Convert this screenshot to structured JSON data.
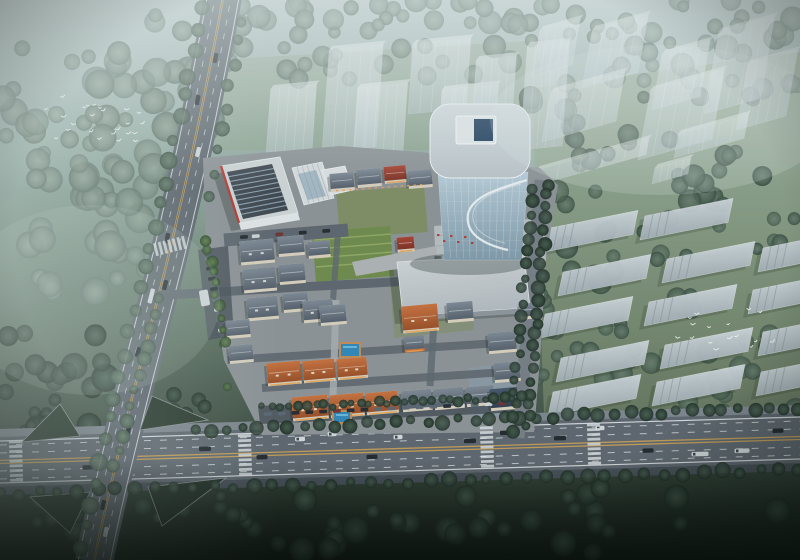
{
  "meta": {
    "subject": "Dusk aerial rendering of a mixed-use development: central glass office tower, low-rise European village with orange and slate roofs, striped-roof commercial block, tree-lined boulevards with traffic, ghosted context towers and slab housing rows, flocks of white birds"
  },
  "palette": {
    "sky_top": "#b9c8c7",
    "sky_mid": "#8ea69c",
    "sky_low": "#5e7263",
    "ground_dark": "#141e17",
    "mist": "#e2ebeb",
    "forest_dark": "#2c3e33",
    "forest_mid": "#4d6253",
    "forest_hazy": "#76897e",
    "tree_site": "#3f5d36",
    "tree_yellow": "#b5913c",
    "lawn_right": "#8a9a77",
    "lawn_site": "#7d8d5e",
    "lawn_bright": "#6f8a4a",
    "road": "#5d656d",
    "road_dark": "#464e56",
    "sidewalk": "#7c848c",
    "lane_yellow": "#c29a55",
    "lane_white": "#e8ecef",
    "pavement": "#8d9296",
    "plaza": "#b7bcbe",
    "facade": "#d8cfbd",
    "roof_orange": "#c8703c",
    "roof_orange_dark": "#9a4e26",
    "roof_slate": "#7d8894",
    "roof_slate_dark": "#545e6a",
    "roof_red": "#a84232",
    "roof_red_dark": "#7c2e22",
    "roof_blue": "#46566b",
    "roof_blue_dark": "#2e3b4d",
    "ghost": "#d9e2e8",
    "slab": "#cdd6dc",
    "slab_dark": "#a9b4bc",
    "glass_light": "#b7ccd8",
    "glass_dark": "#7f98a8",
    "tower_roof": "#d3dade",
    "tower_roof_dark": "#b9c2c8",
    "skylight_blue": "#1f3c5c",
    "hall_light": "#d2d6d8",
    "hall_dark": "#b3bac0",
    "stripe_roof": "#3e454e",
    "stripe_light": "#9fb6c6",
    "accent_red": "#b23b35",
    "pool_blue": "#2f86b8",
    "pool_deck": "#c08b55",
    "car_dark": "#20262c",
    "car_mid": "#5a6673",
    "car_white": "#d3d8db",
    "car_red": "#6e3030",
    "glow_warm": "#e8a04c",
    "bird": "#f2f5f4"
  },
  "scene": {
    "ghost_towers_center": [
      [
        266,
        155,
        46,
        66
      ],
      [
        322,
        152,
        54,
        102
      ],
      [
        352,
        170,
        50,
        82
      ],
      [
        408,
        114,
        58,
        70
      ],
      [
        437,
        162,
        56,
        72
      ],
      [
        472,
        122,
        40,
        62
      ],
      [
        520,
        150,
        42,
        104
      ]
    ],
    "ghost_towers_right": [
      [
        532,
        76,
        40,
        46
      ],
      [
        582,
        88,
        56,
        58
      ],
      [
        652,
        110,
        48,
        56
      ],
      [
        704,
        114,
        56,
        82
      ],
      [
        736,
        130,
        50,
        66
      ],
      [
        542,
        142,
        74,
        50
      ],
      [
        638,
        160,
        74,
        70
      ],
      [
        674,
        158,
        70,
        24
      ],
      [
        534,
        186,
        112,
        16
      ],
      [
        652,
        184,
        36,
        16
      ]
    ],
    "ghost_slabs": [
      [
        545,
        252
      ],
      [
        640,
        240
      ],
      [
        558,
        296
      ],
      [
        662,
        283
      ],
      [
        758,
        272
      ],
      [
        540,
        338
      ],
      [
        644,
        326
      ],
      [
        748,
        314
      ],
      [
        556,
        382
      ],
      [
        660,
        369
      ],
      [
        758,
        356
      ],
      [
        548,
        416
      ],
      [
        652,
        406
      ],
      [
        756,
        396
      ]
    ],
    "village": [
      [
        330,
        173,
        24,
        15,
        "slate"
      ],
      [
        357,
        169,
        24,
        15,
        "slate"
      ],
      [
        384,
        166,
        22,
        14,
        "red"
      ],
      [
        408,
        170,
        24,
        15,
        "slate"
      ],
      [
        240,
        240,
        34,
        21,
        "slate"
      ],
      [
        278,
        236,
        26,
        17,
        "slate"
      ],
      [
        308,
        241,
        22,
        14,
        "slate"
      ],
      [
        243,
        268,
        33,
        21,
        "slate"
      ],
      [
        279,
        264,
        26,
        17,
        "slate"
      ],
      [
        247,
        297,
        31,
        20,
        "slate"
      ],
      [
        283,
        293,
        25,
        16,
        "slate"
      ],
      [
        303,
        300,
        30,
        19,
        "slate"
      ],
      [
        226,
        320,
        24,
        15,
        "slate"
      ],
      [
        229,
        345,
        24,
        15,
        "slate"
      ],
      [
        320,
        305,
        26,
        17,
        "slate"
      ],
      [
        397,
        237,
        17,
        12,
        "red"
      ],
      [
        402,
        305,
        36,
        24,
        "orange"
      ],
      [
        404,
        336,
        20,
        13,
        "orangewall"
      ],
      [
        447,
        302,
        26,
        17,
        "slate"
      ],
      [
        520,
        303,
        20,
        13,
        "slate"
      ],
      [
        488,
        332,
        28,
        18,
        "slate"
      ],
      [
        494,
        362,
        26,
        17,
        "slate"
      ],
      [
        267,
        362,
        34,
        20,
        "orange"
      ],
      [
        303,
        360,
        32,
        19,
        "orange"
      ],
      [
        337,
        358,
        30,
        18,
        "orange"
      ],
      [
        292,
        396,
        36,
        21,
        "orange"
      ],
      [
        330,
        394,
        34,
        20,
        "orange"
      ],
      [
        366,
        392,
        32,
        19,
        "orange"
      ],
      [
        402,
        390,
        30,
        18,
        "slate"
      ],
      [
        434,
        388,
        30,
        18,
        "slate"
      ],
      [
        466,
        386,
        28,
        17,
        "slate"
      ],
      [
        490,
        388,
        28,
        19,
        "blue"
      ]
    ],
    "forest_regions": [
      {
        "x": 0,
        "y": 15,
        "w": 215,
        "h": 180,
        "n": 55,
        "rmin": 7,
        "rmax": 15,
        "fill": "hazy",
        "seed": 3
      },
      {
        "x": 10,
        "y": 150,
        "w": 150,
        "h": 150,
        "n": 28,
        "rmin": 8,
        "rmax": 16,
        "fill": "hazy",
        "seed": 9
      },
      {
        "x": 215,
        "y": 0,
        "w": 330,
        "h": 80,
        "n": 55,
        "rmin": 6,
        "rmax": 12,
        "fill": "hazy",
        "seed": 5
      },
      {
        "x": 545,
        "y": 0,
        "w": 255,
        "h": 90,
        "n": 40,
        "rmin": 6,
        "rmax": 13,
        "fill": "hazy",
        "seed": 6
      },
      {
        "x": 528,
        "y": 95,
        "w": 272,
        "h": 110,
        "n": 38,
        "rmin": 6,
        "rmax": 12,
        "fill": "mid",
        "seed": 7
      },
      {
        "x": 536,
        "y": 205,
        "w": 264,
        "h": 230,
        "n": 62,
        "rmin": 6,
        "rmax": 12,
        "fill": "mid",
        "seed": 8
      },
      {
        "x": 0,
        "y": 310,
        "w": 120,
        "h": 160,
        "n": 26,
        "rmin": 8,
        "rmax": 15,
        "fill": "dark",
        "seed": 10
      },
      {
        "x": 0,
        "y": 488,
        "w": 800,
        "h": 66,
        "n": 40,
        "rmin": 7,
        "rmax": 14,
        "fill": "dark",
        "seed": 11
      },
      {
        "x": 30,
        "y": 398,
        "w": 70,
        "h": 38,
        "n": 6,
        "rmin": 5,
        "rmax": 8,
        "fill": "dark",
        "seed": 15
      },
      {
        "x": 145,
        "y": 394,
        "w": 85,
        "h": 40,
        "n": 7,
        "rmin": 5,
        "rmax": 8,
        "fill": "dark",
        "seed": 16
      },
      {
        "x": 30,
        "y": 490,
        "w": 85,
        "h": 42,
        "n": 7,
        "rmin": 5,
        "rmax": 9,
        "fill": "dark",
        "seed": 17
      },
      {
        "x": 148,
        "y": 484,
        "w": 90,
        "h": 44,
        "n": 8,
        "rmin": 5,
        "rmax": 9,
        "fill": "dark",
        "seed": 18
      },
      {
        "x": 214,
        "y": 228,
        "w": 320,
        "h": 195,
        "n": 58,
        "rmin": 3,
        "rmax": 6,
        "fill": "site",
        "seed": 12
      },
      {
        "x": 220,
        "y": 235,
        "w": 300,
        "h": 180,
        "n": 26,
        "rmin": 2.5,
        "rmax": 5,
        "fill": "yellow",
        "seed": 13
      },
      {
        "x": 430,
        "y": 180,
        "w": 110,
        "h": 58,
        "n": 14,
        "rmin": 4,
        "rmax": 7,
        "fill": "site",
        "seed": 14
      }
    ],
    "tree_rows": [
      {
        "x1": 196,
        "y1": 430,
        "x2": 800,
        "y2": 408,
        "n": 40,
        "r": 6,
        "fill": "dark",
        "seed": 21
      },
      {
        "x1": 0,
        "y1": 494,
        "x2": 800,
        "y2": 470,
        "n": 42,
        "r": 6.5,
        "fill": "dark",
        "seed": 22
      },
      {
        "x1": 204,
        "y1": 10,
        "x2": 80,
        "y2": 548,
        "n": 26,
        "r": 7,
        "fill": "mid",
        "seed": 23
      },
      {
        "x1": 242,
        "y1": 20,
        "x2": 208,
        "y2": 195,
        "n": 9,
        "r": 6,
        "fill": "mid",
        "seed": 24
      },
      {
        "x1": 160,
        "y1": 300,
        "x2": 114,
        "y2": 468,
        "n": 12,
        "r": 6,
        "fill": "mid",
        "seed": 29
      },
      {
        "x1": 548,
        "y1": 184,
        "x2": 528,
        "y2": 428,
        "n": 22,
        "r": 6,
        "fill": "dark",
        "seed": 25
      },
      {
        "x1": 532,
        "y1": 188,
        "x2": 512,
        "y2": 430,
        "n": 20,
        "r": 5.5,
        "fill": "dark",
        "seed": 26
      },
      {
        "x1": 262,
        "y1": 408,
        "x2": 522,
        "y2": 398,
        "n": 30,
        "r": 4.5,
        "fill": "dark",
        "seed": 27
      },
      {
        "x1": 206,
        "y1": 240,
        "x2": 224,
        "y2": 340,
        "n": 10,
        "r": 5,
        "fill": "site",
        "seed": 28
      }
    ],
    "bird_flocks": [
      {
        "x": 45,
        "y": 86,
        "w": 102,
        "h": 56,
        "n": 24,
        "seed": 31
      },
      {
        "x": 670,
        "y": 298,
        "w": 104,
        "h": 56,
        "n": 16,
        "seed": 32
      }
    ],
    "cars_main": [
      [
        88,
        8,
        "dark",
        11
      ],
      [
        205,
        -7,
        "dark",
        12
      ],
      [
        262,
        3,
        "dark",
        11
      ],
      [
        300,
        -14,
        "white",
        10
      ],
      [
        332,
        -18,
        "white",
        9
      ],
      [
        372,
        6,
        "dark",
        11
      ],
      [
        398,
        -13,
        "white",
        9
      ],
      [
        470,
        -7,
        "dark",
        12
      ],
      [
        508,
        -14,
        "dark",
        16
      ],
      [
        560,
        -7,
        "dark",
        12
      ],
      [
        600,
        -16,
        "white",
        9
      ],
      [
        648,
        8,
        "dark",
        11
      ],
      [
        700,
        13,
        "white",
        17
      ],
      [
        742,
        11,
        "white",
        15
      ],
      [
        778,
        -8,
        "dark",
        11
      ]
    ],
    "cars_left": [
      [
        58,
        4,
        "dark"
      ],
      [
        100,
        -6,
        "dark"
      ],
      [
        152,
        5,
        "white"
      ],
      [
        238,
        -5,
        "dark"
      ],
      [
        285,
        5,
        "dark"
      ],
      [
        296,
        -6,
        "bus"
      ],
      [
        352,
        -5,
        "dark"
      ],
      [
        430,
        4,
        "dark"
      ],
      [
        505,
        -4,
        "dark"
      ],
      [
        532,
        5,
        "white"
      ]
    ],
    "left_road_centerline": [
      [
        224,
        -8
      ],
      [
        196,
        140
      ],
      [
        178,
        215
      ],
      [
        146,
        340
      ],
      [
        128,
        414
      ],
      [
        94,
        562
      ]
    ],
    "parked_rows": [
      {
        "x1": 208,
        "y1": 258,
        "x2": 222,
        "y2": 330,
        "n": 8,
        "perp": true,
        "seed": 41
      },
      {
        "x1": 244,
        "y1": 237,
        "x2": 338,
        "y2": 230,
        "n": 9,
        "perp": false,
        "seed": 42
      },
      {
        "x1": 268,
        "y1": 414,
        "x2": 516,
        "y2": 403,
        "n": 19,
        "perp": false,
        "seed": 43
      }
    ],
    "crosswalks": [
      {
        "x": 245,
        "y": 455,
        "orient": "h",
        "rot": -1.8,
        "n": 9,
        "len": 13
      },
      {
        "x": 487,
        "y": 447,
        "orient": "h",
        "rot": -1.8,
        "n": 9,
        "len": 13
      },
      {
        "x": 594,
        "y": 444,
        "orient": "h",
        "rot": -1.8,
        "n": 9,
        "len": 13
      },
      {
        "x": 16,
        "y": 461,
        "orient": "h",
        "rot": -1.8,
        "n": 9,
        "len": 13
      },
      {
        "x": 170,
        "y": 246,
        "orient": "v",
        "rot": -14,
        "n": 7,
        "len": 13
      }
    ],
    "pools": [
      [
        341,
        344,
        18,
        12
      ],
      [
        334,
        412,
        16,
        10
      ]
    ],
    "arcade_glow": {
      "x1": 336,
      "y1": 190,
      "x2": 420,
      "y2": 184,
      "n": 14
    },
    "plaza_red_dots": [
      [
        437,
        234
      ],
      [
        443,
        240
      ],
      [
        450,
        235
      ],
      [
        457,
        241
      ],
      [
        464,
        236
      ],
      [
        471,
        242
      ]
    ]
  }
}
